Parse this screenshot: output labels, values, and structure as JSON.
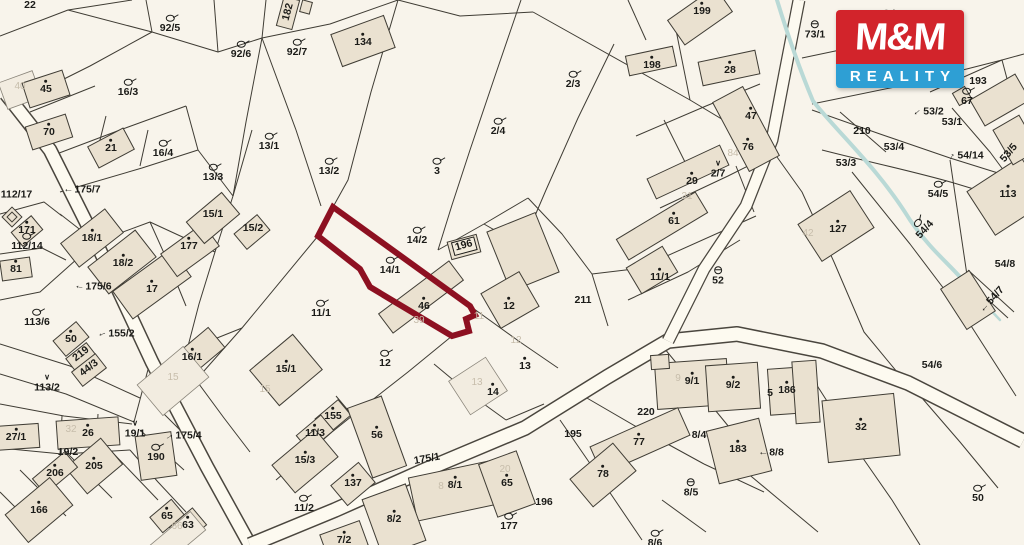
{
  "logo": {
    "line1": "M&M",
    "line2": "REALITY",
    "red": "#d2242b",
    "blue": "#2e9fd4"
  },
  "map": {
    "background": "#f8f4eb",
    "highlight_color": "#8d1021",
    "highlighted_parcel": {
      "parcel_label": "14/1",
      "building_label": "46"
    },
    "labels": [
      {
        "t": "22",
        "x": 30,
        "y": 5
      },
      {
        "t": "92/5",
        "x": 170,
        "y": 24,
        "sym": "q"
      },
      {
        "t": "92/6",
        "x": 241,
        "y": 50,
        "sym": "q"
      },
      {
        "t": "92/7",
        "x": 297,
        "y": 48,
        "sym": "q"
      },
      {
        "t": "134",
        "x": 363,
        "y": 40,
        "c": "b",
        "sym": "d"
      },
      {
        "t": "182",
        "x": 288,
        "y": 12,
        "r": -75
      },
      {
        "t": "45",
        "x": 46,
        "y": 87,
        "c": "b",
        "sym": "d"
      },
      {
        "t": "16/3",
        "x": 128,
        "y": 88,
        "sym": "q"
      },
      {
        "t": "70",
        "x": 49,
        "y": 130,
        "c": "b",
        "sym": "d"
      },
      {
        "t": "21",
        "x": 111,
        "y": 146,
        "c": "b",
        "sym": "d"
      },
      {
        "t": "16/4",
        "x": 163,
        "y": 149,
        "sym": "q"
      },
      {
        "t": "13/1",
        "x": 269,
        "y": 142,
        "sym": "q"
      },
      {
        "t": "13/3",
        "x": 213,
        "y": 173,
        "sym": "q"
      },
      {
        "t": "13/2",
        "x": 329,
        "y": 167,
        "sym": "q"
      },
      {
        "t": "3",
        "x": 437,
        "y": 167,
        "sym": "q"
      },
      {
        "t": "2/4",
        "x": 498,
        "y": 127,
        "sym": "q"
      },
      {
        "t": "2/3",
        "x": 573,
        "y": 80,
        "sym": "q"
      },
      {
        "t": "199",
        "x": 702,
        "y": 9,
        "c": "b",
        "sym": "d"
      },
      {
        "t": "198",
        "x": 652,
        "y": 63,
        "c": "b",
        "sym": "d"
      },
      {
        "t": "28",
        "x": 730,
        "y": 68,
        "c": "b",
        "sym": "d"
      },
      {
        "t": "73/1",
        "x": 815,
        "y": 30,
        "sym": "th"
      },
      {
        "t": "72/3",
        "x": 886,
        "y": 19,
        "sym": "q"
      },
      {
        "t": "193",
        "x": 978,
        "y": 81
      },
      {
        "t": "67",
        "x": 967,
        "y": 97,
        "sym": "q"
      },
      {
        "t": "53/2",
        "x": 928,
        "y": 112,
        "sym": "ar",
        "ar": 140
      },
      {
        "t": "53/1",
        "x": 952,
        "y": 122
      },
      {
        "t": "210",
        "x": 862,
        "y": 131
      },
      {
        "t": "53/4",
        "x": 894,
        "y": 147
      },
      {
        "t": "53/3",
        "x": 846,
        "y": 163
      },
      {
        "t": "54/14",
        "x": 965,
        "y": 156,
        "sym": "ar",
        "ar": -60
      },
      {
        "t": "53/5",
        "x": 1009,
        "y": 153,
        "r": -50
      },
      {
        "t": "113",
        "x": 1008,
        "y": 192,
        "c": "b",
        "sym": "d"
      },
      {
        "t": "54/5",
        "x": 938,
        "y": 190,
        "sym": "q"
      },
      {
        "t": "54/4",
        "x": 922,
        "y": 227,
        "r": -48,
        "sym": "q"
      },
      {
        "t": "54/8",
        "x": 1005,
        "y": 264
      },
      {
        "t": "54/7",
        "x": 992,
        "y": 300,
        "r": -48,
        "sym": "ar",
        "ar": 180
      },
      {
        "t": "54/6",
        "x": 932,
        "y": 365
      },
      {
        "t": "50",
        "x": 978,
        "y": 494,
        "sym": "q"
      },
      {
        "t": "32",
        "x": 861,
        "y": 425,
        "c": "b",
        "sym": "d"
      },
      {
        "t": "127",
        "x": 838,
        "y": 227,
        "c": "b",
        "sym": "d"
      },
      {
        "t": "47",
        "x": 751,
        "y": 114,
        "c": "b",
        "sym": "d"
      },
      {
        "t": "76",
        "x": 748,
        "y": 145,
        "c": "b",
        "sym": "d"
      },
      {
        "t": "2/7",
        "x": 718,
        "y": 169,
        "sym": "v"
      },
      {
        "t": "29",
        "x": 692,
        "y": 179,
        "c": "b",
        "sym": "d"
      },
      {
        "t": "61",
        "x": 674,
        "y": 219,
        "c": "b",
        "sym": "d"
      },
      {
        "t": "11/1",
        "x": 660,
        "y": 275,
        "c": "b",
        "sym": "d"
      },
      {
        "t": "52",
        "x": 718,
        "y": 276,
        "sym": "th"
      },
      {
        "t": "211",
        "x": 583,
        "y": 300
      },
      {
        "t": "12",
        "x": 509,
        "y": 304,
        "c": "b",
        "sym": "d"
      },
      {
        "t": "196",
        "x": 464,
        "y": 246,
        "c": "box",
        "r": -15
      },
      {
        "t": "14/2",
        "x": 417,
        "y": 236,
        "sym": "q"
      },
      {
        "t": "14/1",
        "x": 390,
        "y": 266,
        "sym": "q"
      },
      {
        "t": "46",
        "x": 424,
        "y": 304,
        "c": "b",
        "sym": "d"
      },
      {
        "t": "11/1",
        "x": 321,
        "y": 309,
        "sym": "q"
      },
      {
        "t": "12",
        "x": 385,
        "y": 359,
        "sym": "q"
      },
      {
        "t": "15/1",
        "x": 286,
        "y": 367,
        "c": "b",
        "sym": "d"
      },
      {
        "t": "16/1",
        "x": 192,
        "y": 355,
        "c": "b",
        "sym": "d"
      },
      {
        "t": "11/3",
        "x": 315,
        "y": 431,
        "c": "b",
        "sym": "d"
      },
      {
        "t": "15/3",
        "x": 305,
        "y": 458,
        "c": "b",
        "sym": "d"
      },
      {
        "t": "155",
        "x": 333,
        "y": 414,
        "c": "b",
        "sym": "d"
      },
      {
        "t": "56",
        "x": 377,
        "y": 433,
        "c": "b",
        "sym": "d"
      },
      {
        "t": "137",
        "x": 353,
        "y": 481,
        "c": "b",
        "sym": "d"
      },
      {
        "t": "11/2",
        "x": 304,
        "y": 504,
        "sym": "q"
      },
      {
        "t": "175/1",
        "x": 427,
        "y": 459,
        "r": -10
      },
      {
        "t": "13",
        "x": 525,
        "y": 364,
        "c": "b",
        "sym": "d"
      },
      {
        "t": "14",
        "x": 493,
        "y": 390,
        "c": "b",
        "sym": "d"
      },
      {
        "t": "8/1",
        "x": 455,
        "y": 483,
        "c": "b",
        "sym": "d"
      },
      {
        "t": "65",
        "x": 507,
        "y": 481,
        "c": "b",
        "sym": "d"
      },
      {
        "t": "196",
        "x": 544,
        "y": 502
      },
      {
        "t": "177",
        "x": 509,
        "y": 522,
        "sym": "q"
      },
      {
        "t": "8/2",
        "x": 394,
        "y": 517,
        "c": "b",
        "sym": "d"
      },
      {
        "t": "7/2",
        "x": 344,
        "y": 538,
        "c": "b",
        "sym": "d"
      },
      {
        "t": "220",
        "x": 646,
        "y": 412
      },
      {
        "t": "77",
        "x": 639,
        "y": 440,
        "c": "b",
        "sym": "d"
      },
      {
        "t": "8/4",
        "x": 699,
        "y": 435
      },
      {
        "t": "183",
        "x": 738,
        "y": 447,
        "c": "b",
        "sym": "d"
      },
      {
        "t": "8/8",
        "x": 771,
        "y": 453,
        "sym": "ar",
        "ar": 180
      },
      {
        "t": "195",
        "x": 573,
        "y": 434
      },
      {
        "t": "78",
        "x": 603,
        "y": 472,
        "c": "b",
        "sym": "d"
      },
      {
        "t": "8/5",
        "x": 691,
        "y": 488,
        "sym": "th"
      },
      {
        "t": "8/6",
        "x": 655,
        "y": 539,
        "sym": "q"
      },
      {
        "t": "9/1",
        "x": 692,
        "y": 379,
        "c": "b",
        "sym": "d"
      },
      {
        "t": "9/2",
        "x": 733,
        "y": 383,
        "c": "b",
        "sym": "d"
      },
      {
        "t": "5",
        "x": 770,
        "y": 393
      },
      {
        "t": "186",
        "x": 787,
        "y": 388,
        "c": "b",
        "sym": "d"
      },
      {
        "t": "15/1",
        "x": 213,
        "y": 214
      },
      {
        "t": "15/2",
        "x": 253,
        "y": 228
      },
      {
        "t": "177",
        "x": 189,
        "y": 244,
        "c": "b",
        "sym": "d"
      },
      {
        "t": "18/1",
        "x": 92,
        "y": 236,
        "c": "b",
        "sym": "d"
      },
      {
        "t": "18/2",
        "x": 123,
        "y": 261,
        "c": "b",
        "sym": "d"
      },
      {
        "t": "17",
        "x": 152,
        "y": 287,
        "c": "b",
        "sym": "d"
      },
      {
        "t": "175/7",
        "x": 82,
        "y": 190,
        "sym": "ar",
        "ar": 180
      },
      {
        "t": "112/17",
        "x": 11,
        "y": 195,
        "sym": "ar",
        "ar": 200
      },
      {
        "t": "171",
        "x": 27,
        "y": 228,
        "c": "b",
        "sym": "d"
      },
      {
        "t": "112/14",
        "x": 27,
        "y": 242,
        "sym": "q"
      },
      {
        "t": "81",
        "x": 16,
        "y": 267,
        "c": "b",
        "sym": "d"
      },
      {
        "t": "113/6",
        "x": 37,
        "y": 318,
        "sym": "q"
      },
      {
        "t": "50",
        "x": 71,
        "y": 337,
        "c": "b",
        "sym": "d"
      },
      {
        "t": "155/2",
        "x": 116,
        "y": 334,
        "sym": "ar",
        "ar": 160
      },
      {
        "t": "175/6",
        "x": 93,
        "y": 287,
        "sym": "ar",
        "ar": 190
      },
      {
        "t": "219",
        "x": 81,
        "y": 354,
        "r": -38
      },
      {
        "t": "44/3",
        "x": 89,
        "y": 368,
        "r": -38
      },
      {
        "t": "113/2",
        "x": 47,
        "y": 383,
        "sym": "v"
      },
      {
        "t": "27/1",
        "x": 16,
        "y": 435,
        "c": "b",
        "sym": "d"
      },
      {
        "t": "26",
        "x": 88,
        "y": 431,
        "c": "b",
        "sym": "d"
      },
      {
        "t": "19/2",
        "x": 68,
        "y": 452
      },
      {
        "t": "206",
        "x": 55,
        "y": 471,
        "c": "b",
        "sym": "d"
      },
      {
        "t": "205",
        "x": 94,
        "y": 464,
        "c": "b",
        "sym": "d"
      },
      {
        "t": "166",
        "x": 39,
        "y": 508,
        "c": "b",
        "sym": "d"
      },
      {
        "t": "19/1",
        "x": 135,
        "y": 429,
        "sym": "v"
      },
      {
        "t": "190",
        "x": 156,
        "y": 453,
        "sym": "q"
      },
      {
        "t": "175/4",
        "x": 183,
        "y": 436,
        "sym": "ar",
        "ar": -30
      },
      {
        "t": "65",
        "x": 167,
        "y": 514,
        "c": "b",
        "sym": "d"
      },
      {
        "t": "63",
        "x": 188,
        "y": 523,
        "c": "b",
        "sym": "d"
      },
      {
        "t": "40",
        "x": 20,
        "y": 87,
        "c": "f"
      },
      {
        "t": "15",
        "x": 173,
        "y": 378,
        "c": "f"
      },
      {
        "t": "15",
        "x": 265,
        "y": 390,
        "c": "f"
      },
      {
        "t": "32",
        "x": 71,
        "y": 430,
        "c": "f"
      },
      {
        "t": "39",
        "x": 419,
        "y": 321,
        "c": "f"
      },
      {
        "t": "11",
        "x": 479,
        "y": 317,
        "c": "f"
      },
      {
        "t": "12",
        "x": 516,
        "y": 341,
        "c": "f"
      },
      {
        "t": "13",
        "x": 477,
        "y": 383,
        "c": "f"
      },
      {
        "t": "8",
        "x": 441,
        "y": 487,
        "c": "f"
      },
      {
        "t": "20",
        "x": 505,
        "y": 470,
        "c": "f"
      },
      {
        "t": "9",
        "x": 678,
        "y": 379,
        "c": "f"
      },
      {
        "t": "42",
        "x": 808,
        "y": 234,
        "c": "f"
      },
      {
        "t": "84",
        "x": 733,
        "y": 154,
        "c": "f"
      },
      {
        "t": "31",
        "x": 687,
        "y": 197,
        "c": "f"
      },
      {
        "t": "66",
        "x": 177,
        "y": 527,
        "c": "f"
      }
    ]
  }
}
